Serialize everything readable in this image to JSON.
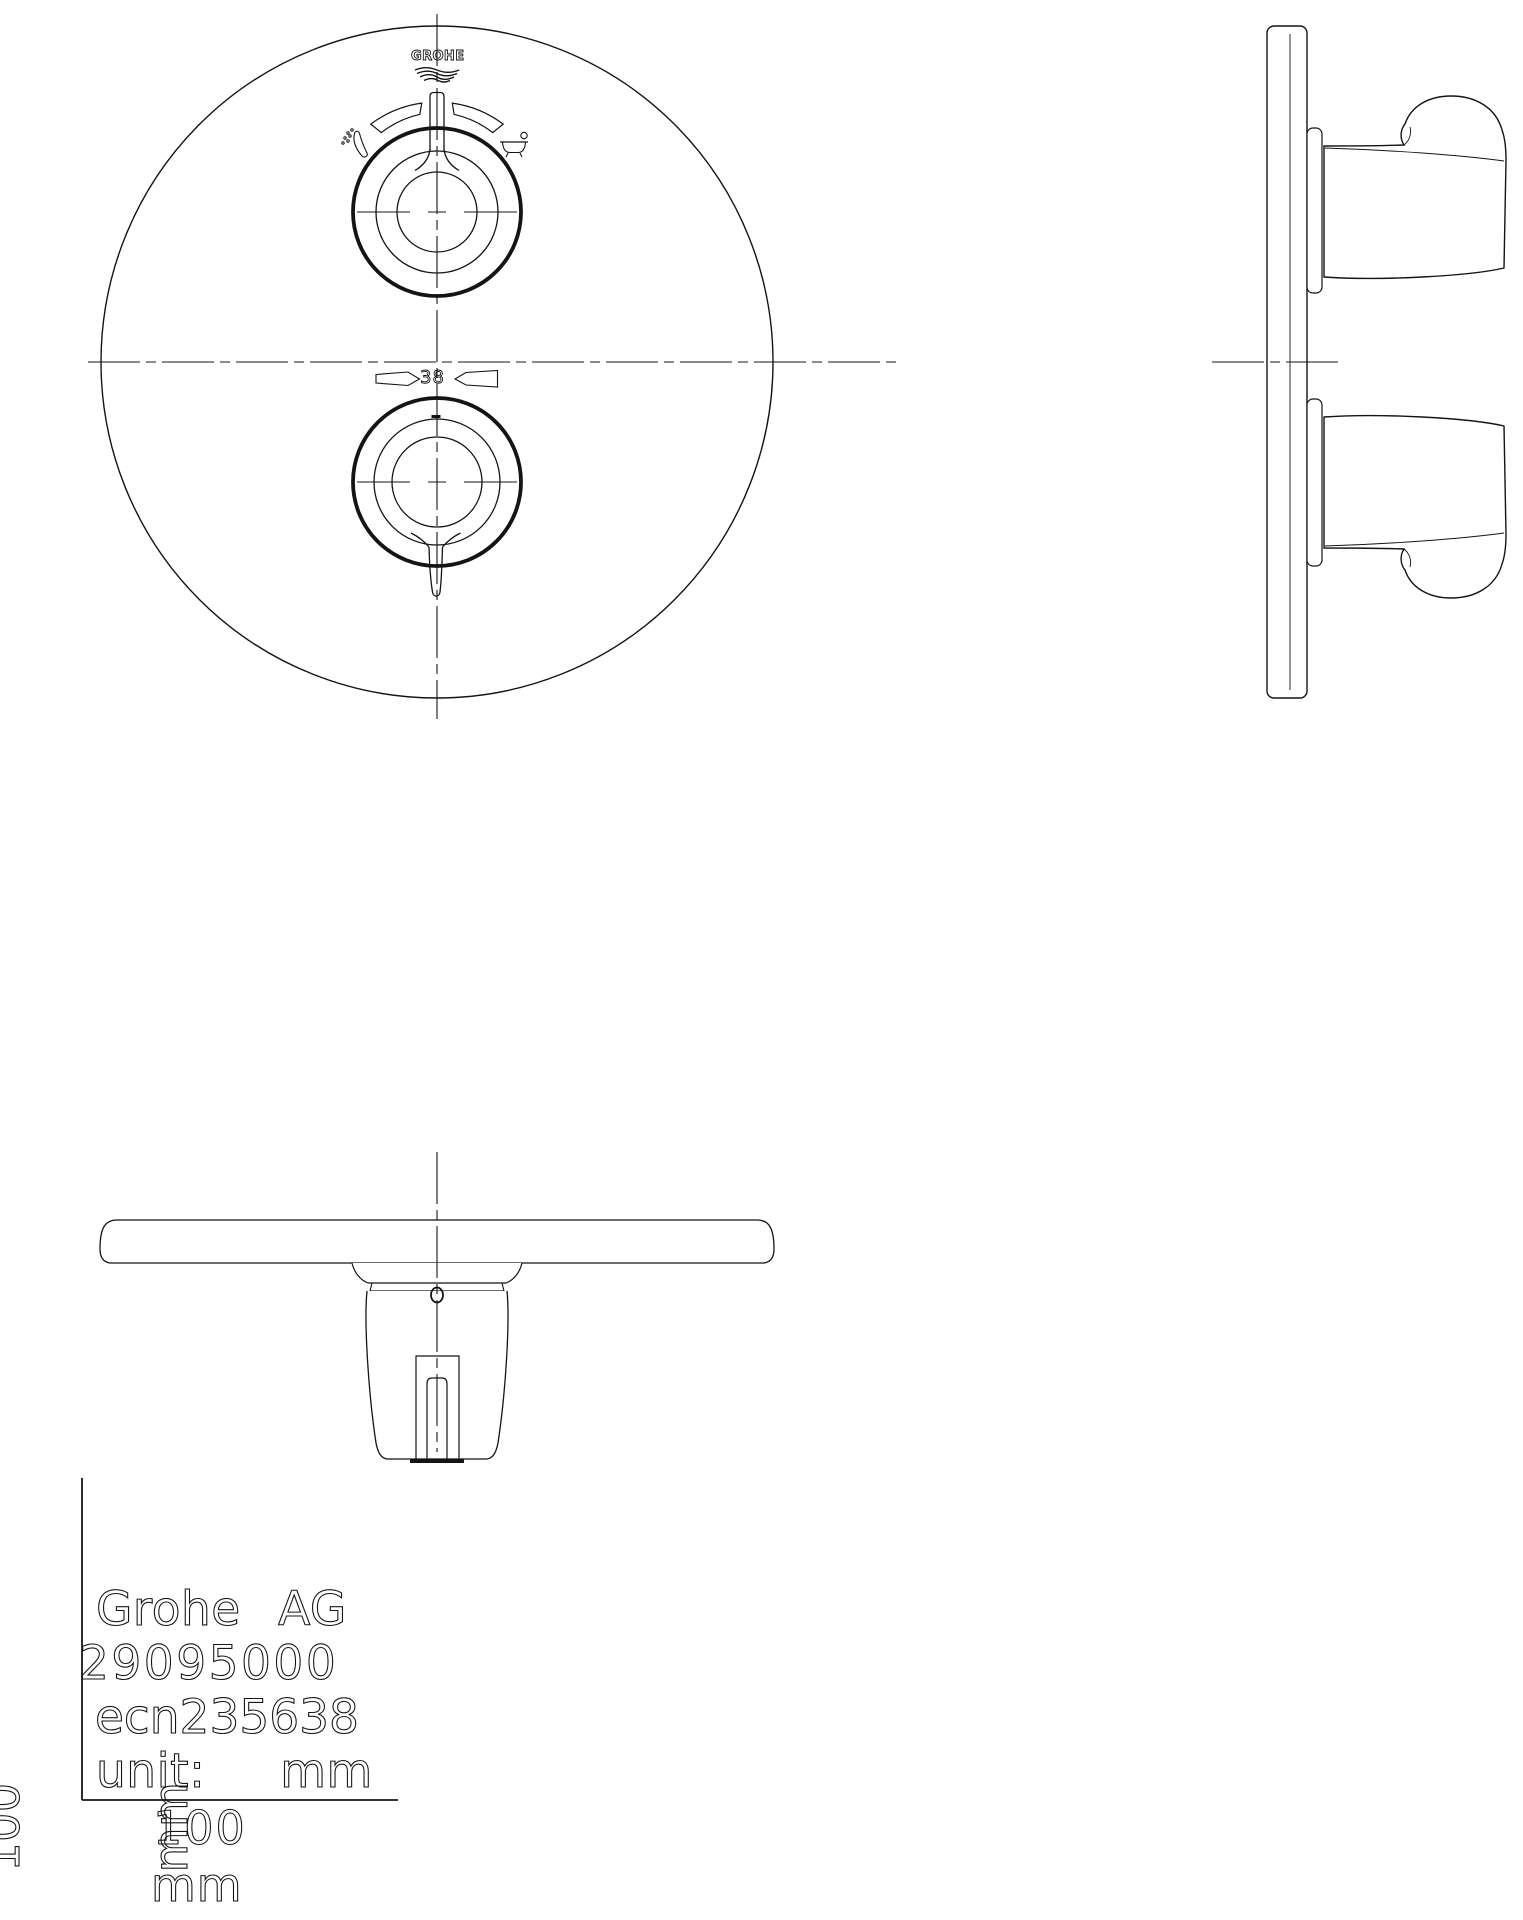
{
  "page": {
    "background": "#ffffff",
    "line_color": "#141414"
  },
  "logo": {
    "text": "GROHE"
  },
  "front_view": {
    "temperature_stop_label": "38",
    "icons": [
      "hand-shower",
      "bathtub"
    ]
  },
  "title_block": {
    "manufacturer": "Grohe AG",
    "product_number": "29095000",
    "ecn_number": "ecn235638",
    "unit_note": "unit:  mm",
    "vertical_scale": {
      "value": "100",
      "unit": "mm"
    },
    "horizontal_scale": {
      "value": "100",
      "unit": "mm"
    }
  }
}
